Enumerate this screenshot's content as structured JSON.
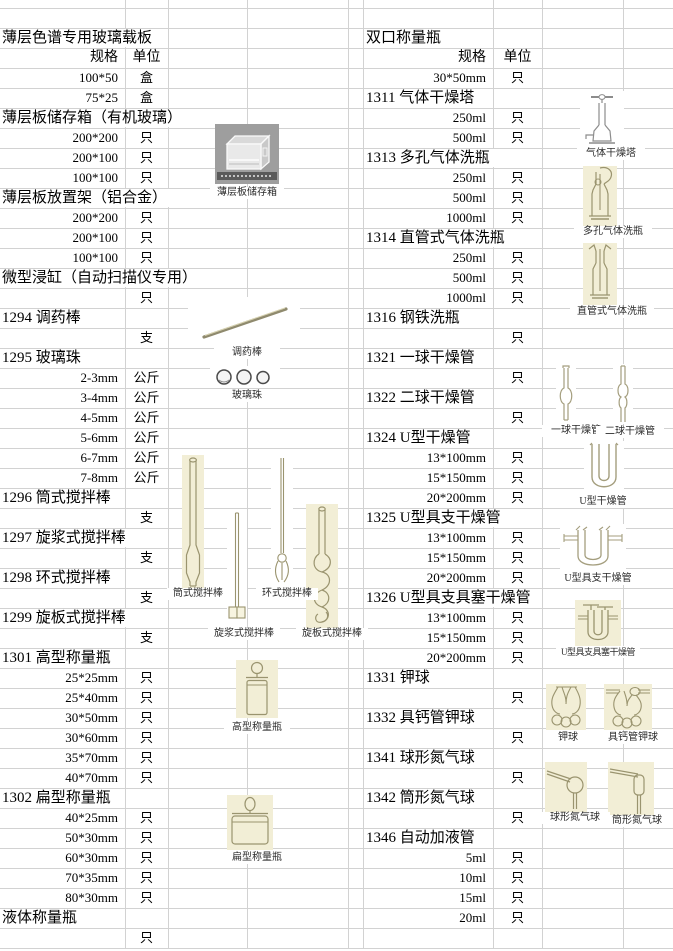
{
  "headers": {
    "spec": "规格",
    "unit": "单位"
  },
  "colors": {
    "gridline": "#d2d2d2",
    "image_bg": "#f2eed6",
    "photo_bg": "#9e9e9e",
    "line_art": "#9a946f",
    "text": "#000000"
  },
  "left_rows": [
    {
      "t": "e"
    },
    {
      "t": "title",
      "l": "薄层色谱专用玻璃载板"
    },
    {
      "t": "h"
    },
    {
      "t": "d",
      "s": "100*50",
      "u": "盒"
    },
    {
      "t": "d",
      "s": "75*25",
      "u": "盒"
    },
    {
      "t": "title",
      "l": "薄层板储存箱（有机玻璃）"
    },
    {
      "t": "d",
      "s": "200*200",
      "u": "只"
    },
    {
      "t": "d",
      "s": "200*100",
      "u": "只"
    },
    {
      "t": "d",
      "s": "100*100",
      "u": "只"
    },
    {
      "t": "title",
      "l": "薄层板放置架（铝合金）"
    },
    {
      "t": "d",
      "s": "200*200",
      "u": "只"
    },
    {
      "t": "d",
      "s": "200*100",
      "u": "只"
    },
    {
      "t": "d",
      "s": "100*100",
      "u": "只"
    },
    {
      "t": "title",
      "l": "微型浸缸（自动扫描仪专用）"
    },
    {
      "t": "d",
      "s": "",
      "u": "只"
    },
    {
      "t": "title",
      "l": "1294 调药棒"
    },
    {
      "t": "d",
      "s": "",
      "u": "支"
    },
    {
      "t": "title",
      "l": "1295 玻璃珠"
    },
    {
      "t": "d",
      "s": "2-3mm",
      "u": "公斤"
    },
    {
      "t": "d",
      "s": "3-4mm",
      "u": "公斤"
    },
    {
      "t": "d",
      "s": "4-5mm",
      "u": "公斤"
    },
    {
      "t": "d",
      "s": "5-6mm",
      "u": "公斤"
    },
    {
      "t": "d",
      "s": "6-7mm",
      "u": "公斤"
    },
    {
      "t": "d",
      "s": "7-8mm",
      "u": "公斤"
    },
    {
      "t": "title",
      "l": "1296 筒式搅拌棒"
    },
    {
      "t": "d",
      "s": "",
      "u": "支"
    },
    {
      "t": "title",
      "l": "1297 旋浆式搅拌棒"
    },
    {
      "t": "d",
      "s": "",
      "u": "支"
    },
    {
      "t": "title",
      "l": "1298 环式搅拌棒"
    },
    {
      "t": "d",
      "s": "",
      "u": "支"
    },
    {
      "t": "title",
      "l": "1299 旋板式搅拌棒"
    },
    {
      "t": "d",
      "s": "",
      "u": "支"
    },
    {
      "t": "title",
      "l": "1301 高型称量瓶"
    },
    {
      "t": "d",
      "s": "25*25mm",
      "u": "只"
    },
    {
      "t": "d",
      "s": "25*40mm",
      "u": "只"
    },
    {
      "t": "d",
      "s": "30*50mm",
      "u": "只"
    },
    {
      "t": "d",
      "s": "30*60mm",
      "u": "只"
    },
    {
      "t": "d",
      "s": "35*70mm",
      "u": "只"
    },
    {
      "t": "d",
      "s": "40*70mm",
      "u": "只"
    },
    {
      "t": "title",
      "l": "1302 扁型称量瓶"
    },
    {
      "t": "d",
      "s": "40*25mm",
      "u": "只"
    },
    {
      "t": "d",
      "s": "50*30mm",
      "u": "只"
    },
    {
      "t": "d",
      "s": "60*30mm",
      "u": "只"
    },
    {
      "t": "d",
      "s": "70*35mm",
      "u": "只"
    },
    {
      "t": "d",
      "s": "80*30mm",
      "u": "只"
    },
    {
      "t": "title",
      "l": "液体称量瓶"
    },
    {
      "t": "d",
      "s": "",
      "u": "只"
    }
  ],
  "right_rows": [
    {
      "t": "e"
    },
    {
      "t": "title",
      "l": "双口称量瓶"
    },
    {
      "t": "h"
    },
    {
      "t": "d",
      "s": "30*50mm",
      "u": "只"
    },
    {
      "t": "title",
      "l": "1311 气体干燥塔"
    },
    {
      "t": "d",
      "s": "250ml",
      "u": "只"
    },
    {
      "t": "d",
      "s": "500ml",
      "u": "只"
    },
    {
      "t": "title",
      "l": "1313 多孔气体洗瓶"
    },
    {
      "t": "d",
      "s": "250ml",
      "u": "只"
    },
    {
      "t": "d",
      "s": "500ml",
      "u": "只"
    },
    {
      "t": "d",
      "s": "1000ml",
      "u": "只"
    },
    {
      "t": "title",
      "l": "1314 直管式气体洗瓶"
    },
    {
      "t": "d",
      "s": "250ml",
      "u": "只"
    },
    {
      "t": "d",
      "s": "500ml",
      "u": "只"
    },
    {
      "t": "d",
      "s": "1000ml",
      "u": "只"
    },
    {
      "t": "title",
      "l": "1316 钢铁洗瓶"
    },
    {
      "t": "d",
      "s": "",
      "u": "只"
    },
    {
      "t": "title",
      "l": "1321 一球干燥管"
    },
    {
      "t": "d",
      "s": "",
      "u": "只"
    },
    {
      "t": "title",
      "l": "1322 二球干燥管"
    },
    {
      "t": "d",
      "s": "",
      "u": "只"
    },
    {
      "t": "title",
      "l": "1324 U型干燥管"
    },
    {
      "t": "d",
      "s": "13*100mm",
      "u": "只"
    },
    {
      "t": "d",
      "s": "15*150mm",
      "u": "只"
    },
    {
      "t": "d",
      "s": "20*200mm",
      "u": "只"
    },
    {
      "t": "title",
      "l": "1325 U型具支干燥管"
    },
    {
      "t": "d",
      "s": "13*100mm",
      "u": "只"
    },
    {
      "t": "d",
      "s": "15*150mm",
      "u": "只"
    },
    {
      "t": "d",
      "s": "20*200mm",
      "u": "只"
    },
    {
      "t": "title",
      "l": "1326 U型具支具塞干燥管"
    },
    {
      "t": "d",
      "s": "13*100mm",
      "u": "只"
    },
    {
      "t": "d",
      "s": "15*150mm",
      "u": "只"
    },
    {
      "t": "d",
      "s": "20*200mm",
      "u": "只"
    },
    {
      "t": "title",
      "l": "1331 钾球"
    },
    {
      "t": "d",
      "s": "",
      "u": "只"
    },
    {
      "t": "title",
      "l": "1332 具钙管钾球"
    },
    {
      "t": "d",
      "s": "",
      "u": "只"
    },
    {
      "t": "title",
      "l": "1341 球形氮气球"
    },
    {
      "t": "d",
      "s": "",
      "u": "只"
    },
    {
      "t": "title",
      "l": "1342 筒形氮气球"
    },
    {
      "t": "d",
      "s": "",
      "u": "只"
    },
    {
      "t": "title",
      "l": "1346 自动加液管"
    },
    {
      "t": "d",
      "s": "5ml",
      "u": "只"
    },
    {
      "t": "d",
      "s": "10ml",
      "u": "只"
    },
    {
      "t": "d",
      "s": "15ml",
      "u": "只"
    },
    {
      "t": "d",
      "s": "20ml",
      "u": "只"
    },
    {
      "t": "e"
    }
  ],
  "captions": {
    "box": "薄层板储存箱",
    "rod": "调药棒",
    "beads": "玻璃珠",
    "stirrer_tube": "筒式搅拌棒",
    "stirrer_propeller": "旋浆式搅拌棒",
    "stirrer_ring": "环式搅拌棒",
    "stirrer_plate": "旋板式搅拌棒",
    "tall_bottle": "高型称量瓶",
    "flat_bottle": "扁型称量瓶",
    "drying_tower": "气体干燥塔",
    "porous_washer": "多孔气体洗瓶",
    "straight_washer": "直管式气体洗瓶",
    "one_ball_tube": "一球干燥管",
    "two_ball_tube": "二球干燥管",
    "u_tube": "U型干燥管",
    "u_side_tube": "U型具支干燥管",
    "u_side_stopper_tube": "U型具支具塞干燥管",
    "potash_bulb": "钾球",
    "potash_bulb_ca": "具钙管钾球",
    "ball_nitrogen": "球形氮气球",
    "cylinder_nitrogen": "筒形氮气球"
  }
}
